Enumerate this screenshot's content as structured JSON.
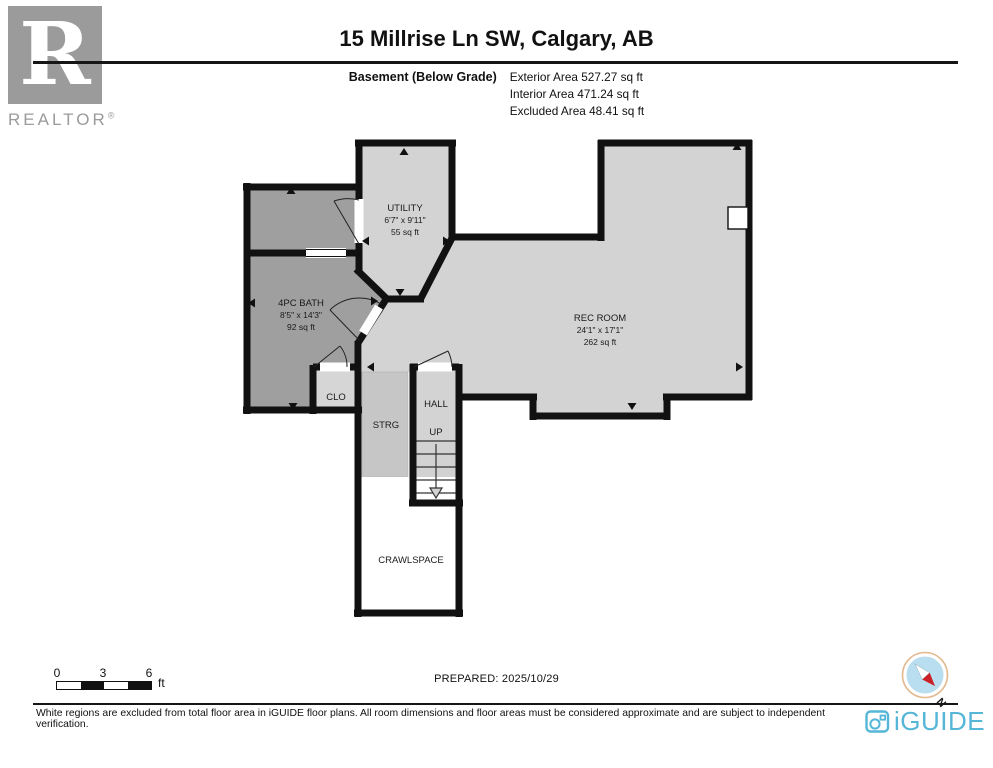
{
  "header": {
    "title": "15 Millrise Ln SW, Calgary, AB",
    "floor_label": "Basement (Below Grade)",
    "stats": [
      "Exterior Area 527.27 sq ft",
      "Interior Area 471.24 sq ft",
      "Excluded Area 48.41 sq ft"
    ]
  },
  "branding": {
    "realtor_letter": "R",
    "realtor_label": "REALTOR",
    "realtor_reg": "®",
    "iguide_label": "iGUIDE"
  },
  "rooms": {
    "utility": {
      "name": "UTILITY",
      "dims": "6'7\" x 9'11\"",
      "area": "55 sq ft"
    },
    "bath": {
      "name": "4PC BATH",
      "dims": "8'5\" x 14'3\"",
      "area": "92 sq ft"
    },
    "rec": {
      "name": "REC ROOM",
      "dims": "24'1\" x 17'1\"",
      "area": "262 sq ft"
    },
    "clo": {
      "name": "CLO"
    },
    "strg": {
      "name": "STRG"
    },
    "hall": {
      "name": "HALL"
    },
    "stairs": {
      "label": "UP"
    },
    "crawlspace": {
      "name": "CRAWLSPACE"
    }
  },
  "scale_bar": {
    "ticks": [
      "0",
      "3",
      "6"
    ],
    "unit": "ft"
  },
  "prepared_label": "PREPARED: 2025/10/29",
  "compass": {
    "north_label": "N"
  },
  "footer": {
    "disclaimer": "White regions are excluded from total floor area in iGUIDE floor plans. All room dimensions and floor areas must be considered approximate and are subject to independent verification."
  },
  "colors": {
    "wall": "#111111",
    "room_light": "#d3d3d3",
    "room_dark": "#9f9f9f",
    "storage": "#c6c6c6",
    "closet": "#d6d6d6",
    "iguide_blue": "#55b6d8",
    "compass_red": "#cc2027"
  }
}
